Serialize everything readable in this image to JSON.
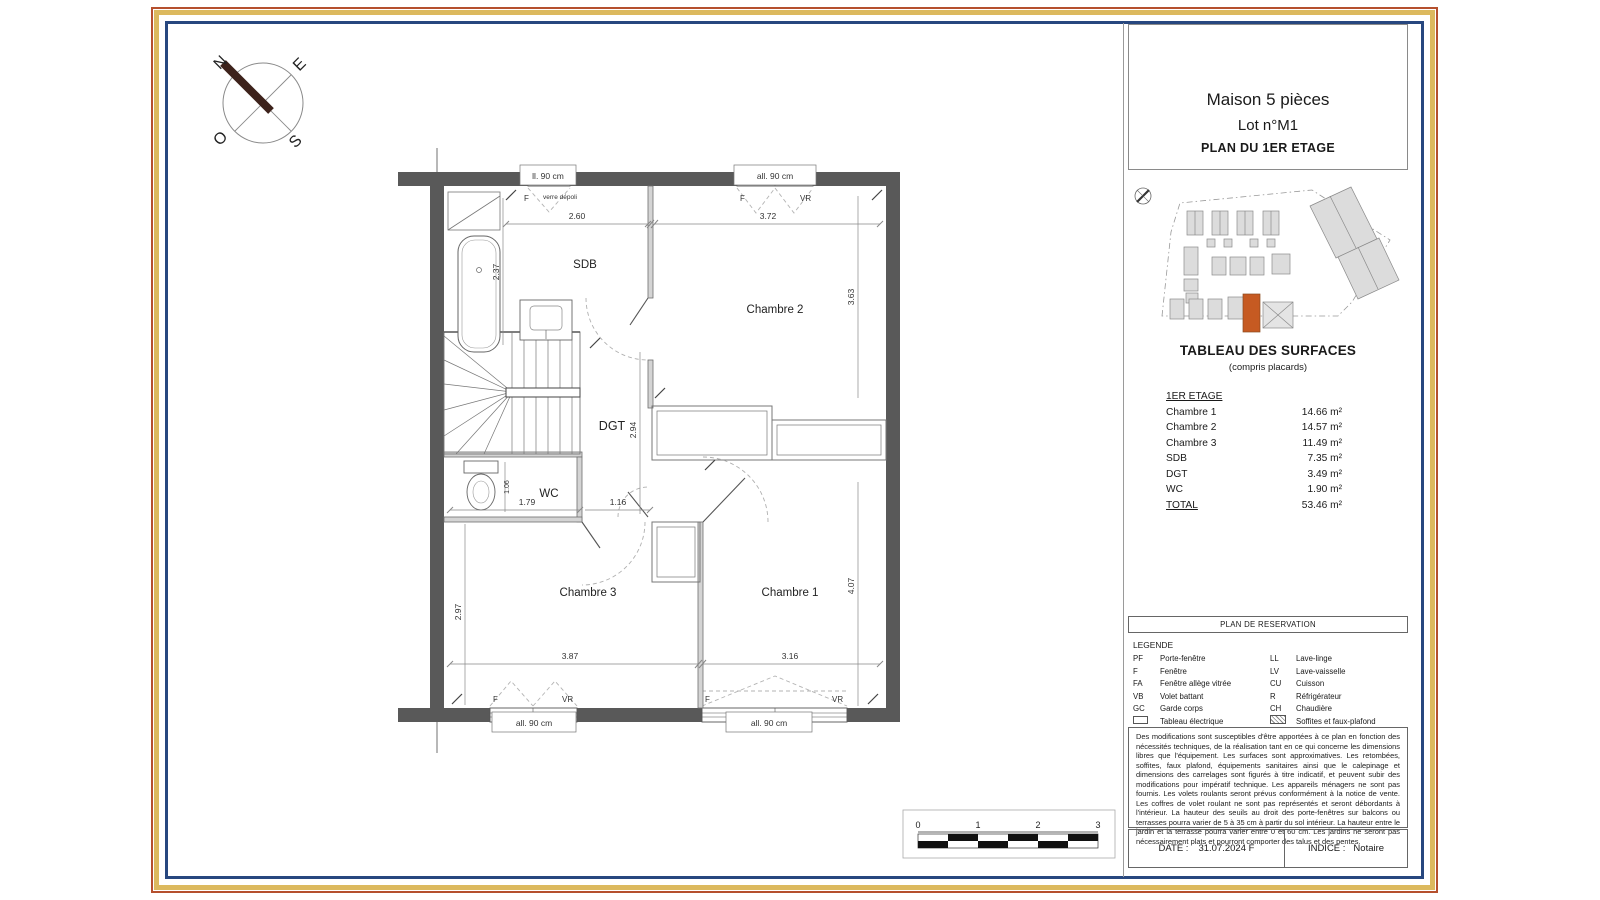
{
  "title_block": {
    "line1": "Maison 5 pièces",
    "line2": "Lot n°M1",
    "line3": "PLAN DU 1ER ETAGE"
  },
  "surface_table": {
    "title": "TABLEAU DES SURFACES",
    "subtitle": "(compris placards)",
    "section": "1ER ETAGE",
    "rows": [
      {
        "label": "Chambre 1",
        "value": "14.66 m²"
      },
      {
        "label": "Chambre 2",
        "value": "14.57 m²"
      },
      {
        "label": "Chambre 3",
        "value": "11.49 m²"
      },
      {
        "label": "SDB",
        "value": "7.35 m²"
      },
      {
        "label": "DGT",
        "value": "3.49 m²"
      },
      {
        "label": "WC",
        "value": "1.90 m²"
      },
      {
        "label": "TOTAL",
        "value": "53.46 m²"
      }
    ]
  },
  "reservation_header": "PLAN DE RESERVATION",
  "legend": {
    "title": "LEGENDE",
    "rows": [
      {
        "abbr_left": "PF",
        "label_left": "Porte-fenêtre",
        "abbr_right": "LL",
        "label_right": "Lave-linge"
      },
      {
        "abbr_left": "F",
        "label_left": "Fenêtre",
        "abbr_right": "LV",
        "label_right": "Lave-vaisselle"
      },
      {
        "abbr_left": "FA",
        "label_left": "Fenêtre allège vitrée",
        "abbr_right": "CU",
        "label_right": "Cuisson"
      },
      {
        "abbr_left": "VB",
        "label_left": "Volet battant",
        "abbr_right": "R",
        "label_right": "Réfrigérateur"
      },
      {
        "abbr_left": "GC",
        "label_left": "Garde corps",
        "abbr_right": "CH",
        "label_right": "Chaudière"
      },
      {
        "abbr_left": "",
        "label_left": "Tableau électrique",
        "abbr_right": "",
        "label_right": "Soffites et faux-plafond"
      }
    ]
  },
  "disclaimer": "Des modifications sont susceptibles d'être apportées à ce plan en fonction des nécessités techniques, de la réalisation tant en ce qui concerne les dimensions libres que l'équipement. Les surfaces sont approximatives. Les retombées, soffites, faux plafond, équipements sanitaires ainsi que le calepinage et dimensions des carrelages sont figurés à titre indicatif, et peuvent subir des modifications pour impératif technique. Les appareils ménagers ne sont pas fournis. Les volets roulants seront prévus conformément à la notice de vente. Les coffres de volet roulant ne sont pas représentés et seront débordants à l'intérieur. La hauteur des seuils au droit des porte-fenêtres sur balcons ou terrasses pourra varier de 5 à 35 cm à partir du sol intérieur. La hauteur entre le jardin et la terrasse pourra varier entre 0 et 60 cm. Les jardins ne seront pas nécessairement plats et pourront comporter des talus et des pentes.",
  "footer": {
    "date_label": "DATE :",
    "date_value": "31.07.2024 F",
    "indice_label": "INDICE :",
    "indice_value": "Notaire"
  },
  "compass": {
    "n": "N",
    "e": "E",
    "s": "S",
    "o": "O"
  },
  "plan": {
    "rooms": {
      "sdb": "SDB",
      "chambre2": "Chambre 2",
      "dgt": "DGT",
      "wc": "WC",
      "chambre3": "Chambre 3",
      "chambre1": "Chambre 1"
    },
    "dims": {
      "d260": "2.60",
      "d372": "3.72",
      "d237": "2.37",
      "d363": "3.63",
      "d294": "2.94",
      "d179": "1.79",
      "d116": "1.16",
      "d106": "1.06",
      "d297": "2.97",
      "d387": "3.87",
      "d316": "3.16",
      "d407": "4.07"
    },
    "windows": {
      "allege": "all. 90 cm",
      "allege_clipped": "ll. 90 cm",
      "f": "F",
      "vr": "VR",
      "note": "verre dépoli"
    }
  },
  "scale_bar": {
    "ticks": [
      "0",
      "1",
      "2",
      "3"
    ]
  },
  "colors": {
    "wall": "#595959",
    "frame_outer": "#b5502e",
    "frame_gold": "#dcb95e",
    "frame_navy": "#27477f",
    "highlight_building": "#c65a22",
    "compass_needle": "#3d221b"
  }
}
